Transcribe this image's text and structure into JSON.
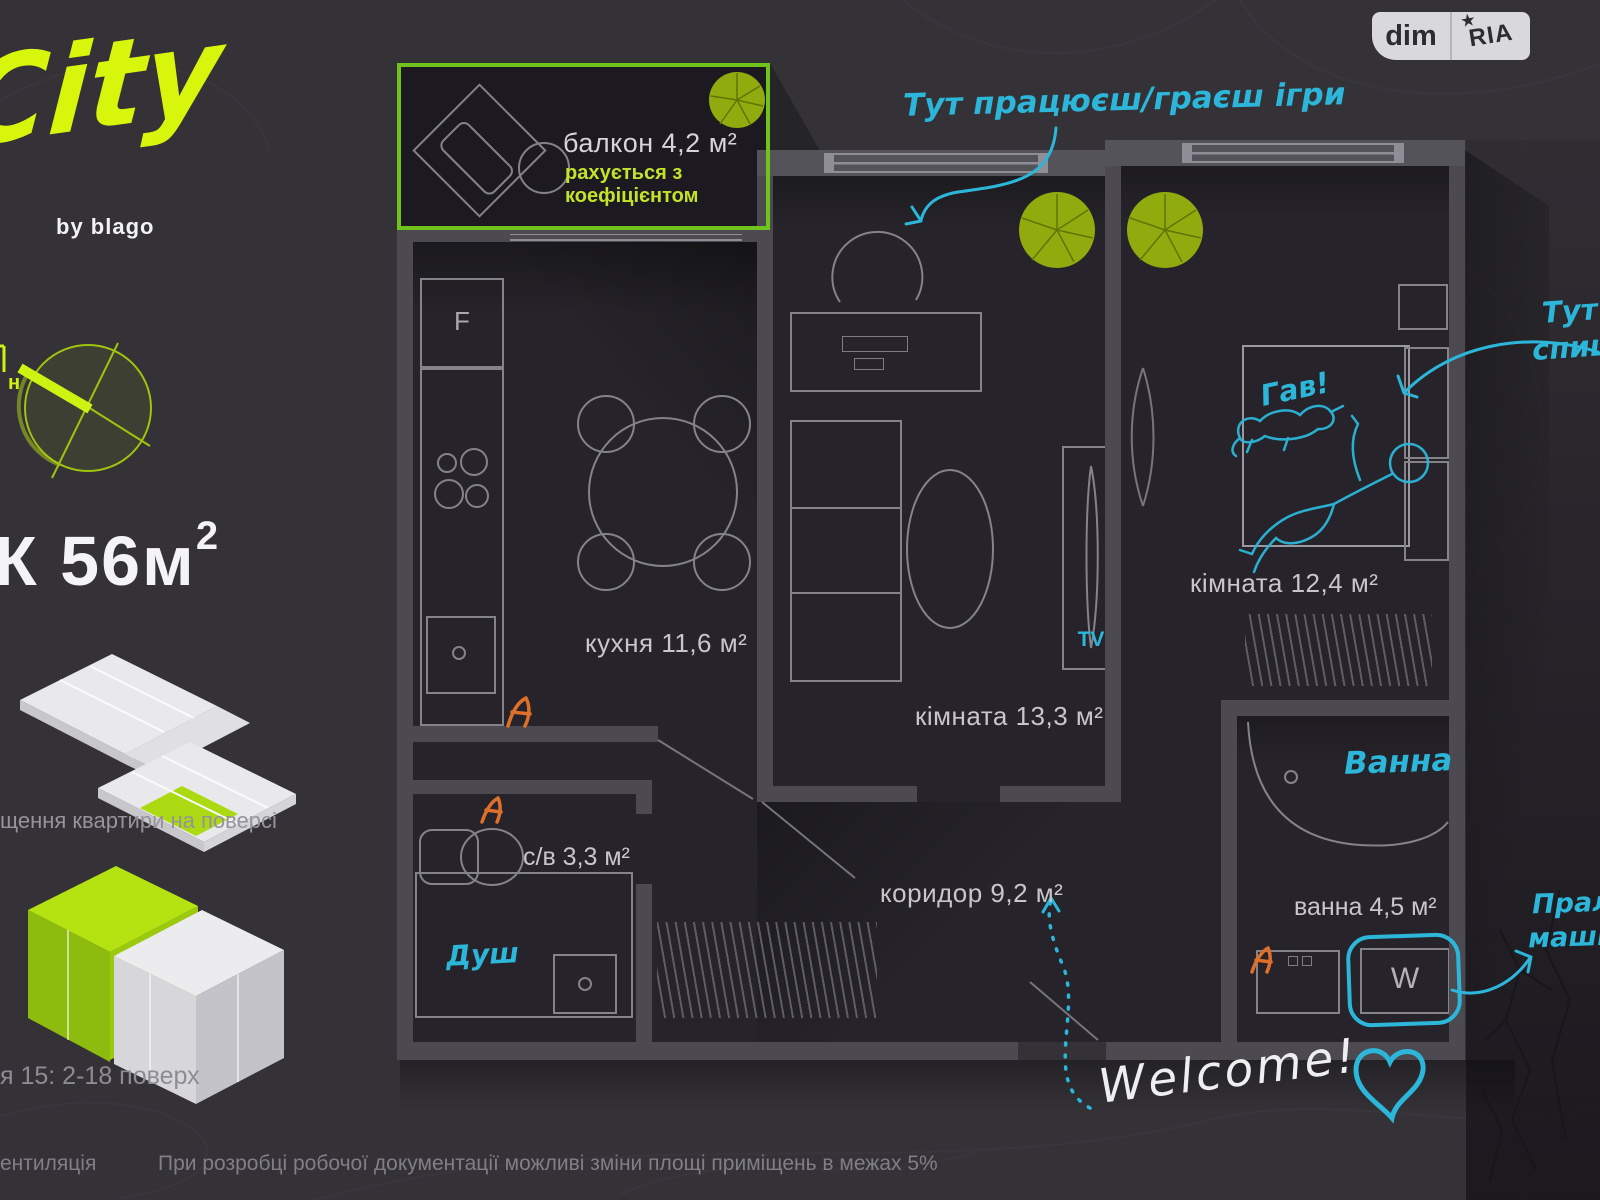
{
  "header": {
    "brand": {
      "logo": "City",
      "byline": "by blago"
    },
    "badge": {
      "left": "dim",
      "right": "RIA",
      "star": "★"
    }
  },
  "sidebar": {
    "compass_north": "н",
    "area_value": "К 56м",
    "area_sup": "2",
    "floorplate_caption": "щення квартири на поверсі",
    "section_caption": "я 15: 2-18 поверх",
    "ventilation_caption": "ентиляція"
  },
  "plan": {
    "balcony": {
      "title": "балкон 4,2 м²",
      "note_line1": "рахується з",
      "note_line2": "коефіцієнтом"
    },
    "rooms": [
      {
        "id": "kitchen",
        "label": "кухня 11,6 м²"
      },
      {
        "id": "room1",
        "label": "кімната 13,3 м²"
      },
      {
        "id": "room2",
        "label": "кімната 12,4 м²"
      },
      {
        "id": "wc",
        "label": "с/в 3,3 м²"
      },
      {
        "id": "corridor",
        "label": "коридор 9,2 м²"
      },
      {
        "id": "bath",
        "label": "ванна 4,5 м²"
      }
    ],
    "appliances": {
      "tv": "TV",
      "washer": "W",
      "fridge": "F"
    }
  },
  "annotations": {
    "work_zone": "Тут працюєш/граєш ігри",
    "sleep_line1": "Тут",
    "sleep_line2": "спиш",
    "dog_bark": "Гав!",
    "bath_note": "Ванна",
    "shower_note": "Душ",
    "washer_line1": "Прал",
    "washer_line2": "маши",
    "welcome": "Welcome!"
  },
  "footer": {
    "disclaimer": "При розробці робочої документації можливі зміни площі приміщень в межах 5%"
  },
  "colors": {
    "accent_green": "#c9ee12",
    "balcony_green": "#6fc31c",
    "cyan": "#2cb7da",
    "orange": "#df7029"
  }
}
